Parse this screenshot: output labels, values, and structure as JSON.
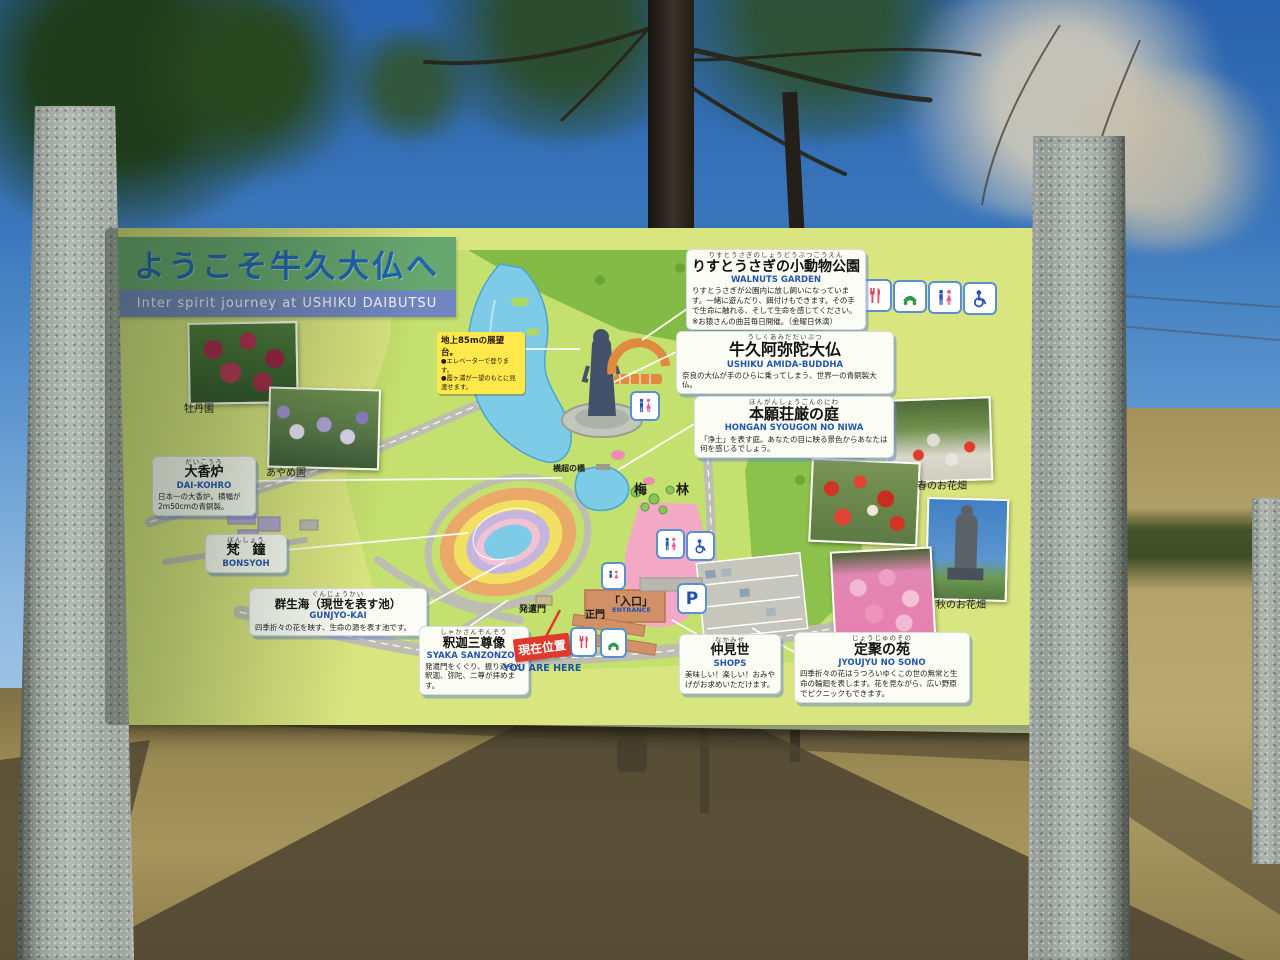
{
  "sign": {
    "title": {
      "jp": "ようこそ牛久大仏へ",
      "en": "Inter spirit journey at USHIKU DAIBUTSU"
    },
    "note_85m": {
      "head": "地上85mの展望台。",
      "b1": "●エレベーターで登ります。",
      "b2": "●霞ヶ浦が一望のもとに見渡せます。"
    },
    "you_are_here": {
      "jp": "現在位置",
      "en": "YOU ARE HERE"
    },
    "labels": [
      {
        "id": "walnuts-garden",
        "furigana": "りすとうさぎのしょうどうぶつこうえん",
        "jp": "りすとうさぎの小動物公園",
        "en": "WALNUTS GARDEN",
        "desc": "りすとうさぎが公園内に放し飼いになっています。一緒に遊んだり、餌付けもできます。その手で生命に触れる、そして生命を感じてください。",
        "note": "※お猿さんの曲芸毎日開催。（金曜日休演）"
      },
      {
        "id": "ushiku-amida-buddha",
        "furigana": "うしくあみだだいぶつ",
        "jp": "牛久阿弥陀大仏",
        "en": "USHIKU AMIDA-BUDDHA",
        "desc": "奈良の大仏が手のひらに乗ってしまう、世界一の青銅製大仏。",
        "note": ""
      },
      {
        "id": "hongan-syougon-no-niwa",
        "furigana": "ほんがんしょうごんのにわ",
        "jp": "本願荘厳の庭",
        "en": "HONGAN SYOUGON NO NIWA",
        "desc": "「浄土」を表す庭。あなたの目に映る景色からあなたは何を感じるでしょう。",
        "note": ""
      },
      {
        "id": "dai-kohro",
        "furigana": "だいこうろ",
        "jp": "大香炉",
        "en": "DAI-KOHRO",
        "desc": "日本一の大香炉。横幅が2m50cmの青銅製。",
        "note": ""
      },
      {
        "id": "bonsyoh",
        "furigana": "ぼんしょう",
        "jp": "梵　鐘",
        "en": "BONSYOH",
        "desc": "",
        "note": ""
      },
      {
        "id": "gunjyo-kai",
        "furigana": "ぐんじょうかい",
        "jp": "群生海（現世を表す池）",
        "en": "GUNJYO-KAI",
        "desc": "四季折々の花を映す、生命の源を表す池です。",
        "note": ""
      },
      {
        "id": "syaka-sanzonzou",
        "furigana": "しゃかさんぞんぞう",
        "jp": "釈迦三尊像",
        "en": "SYAKA SANZONZOU",
        "desc": "発遣門をくぐり、振り返ると釈迦、弥陀、二尊が拝めます。",
        "note": ""
      },
      {
        "id": "nakamise-shops",
        "furigana": "なかみせ",
        "jp": "仲見世",
        "en": "SHOPS",
        "desc": "美味しい！楽しい！おみやげがお求めいただけます。",
        "note": ""
      },
      {
        "id": "jyoujyu-no-sono",
        "furigana": "じょうじゅのその",
        "jp": "定聚の苑",
        "en": "JYOUJYU NO SONO",
        "desc": "四季折々の花はうつろいゆくこの世の無常と生命の輪廻を表します。花を見ながら、広い野原でピクニックもできます。",
        "note": ""
      }
    ],
    "map_texts": {
      "bridge": "横超の橋",
      "plum_grove": "梅　林",
      "hotsugen_gate": "発遣門",
      "main_gate": "正門",
      "entrance_jp": "「入口」",
      "entrance_en": "ENTRANCE",
      "parking_p": "P"
    },
    "photo_captions": {
      "peony": "牡丹園",
      "iris": "あやめ園",
      "spring": "春のお花畑",
      "autumn": "秋のお花畑"
    },
    "facility_icons": [
      "restaurant",
      "telephone",
      "restroom",
      "wheelchair"
    ],
    "colors": {
      "board": "#d9e57f",
      "title_band": "#67a770",
      "subtitle_band": "#7186c1",
      "title_text": "#1d62b4",
      "label_accent": "#2456b0",
      "you_are_here_red": "#e03a2c",
      "note_yellow": "#ffe94a",
      "pond_blue": "#7ecbe8",
      "field_pink": "#f3a8c6"
    }
  }
}
